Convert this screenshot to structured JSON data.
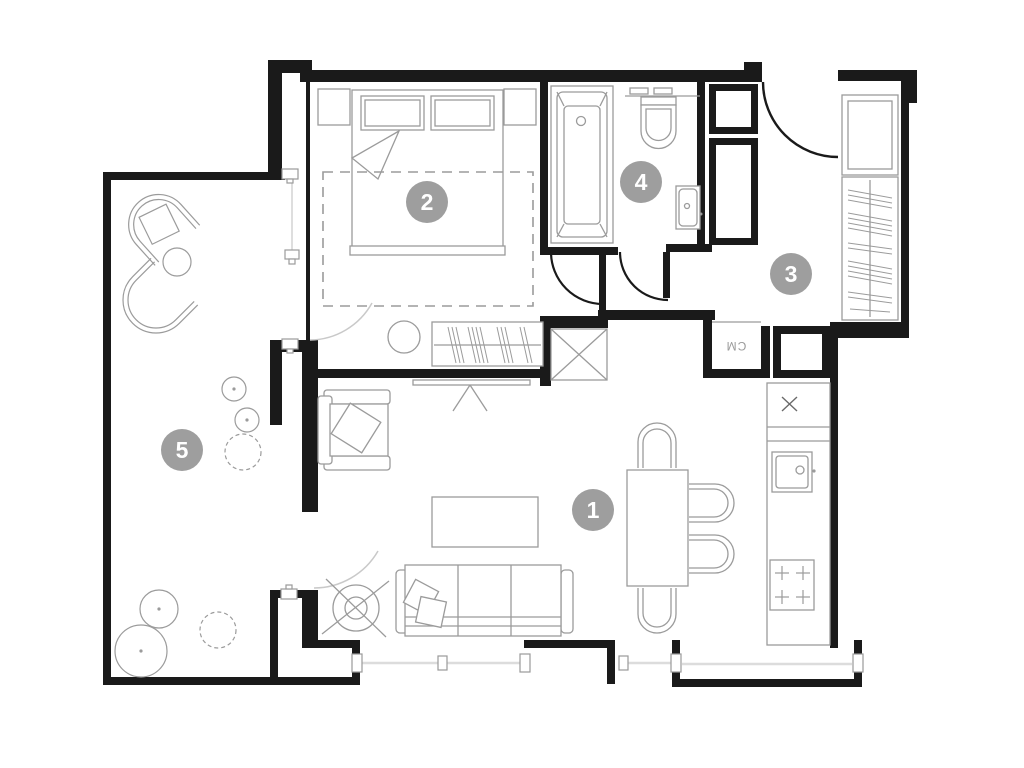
{
  "plan": {
    "type": "apartment-floor-plan",
    "colors": {
      "wall": "#1a1a1a",
      "furniture": "#9b9b9b",
      "furniture_light": "#c9c9c9",
      "badge": "#9e9e9e",
      "badge_text": "#ffffff",
      "background": "#ffffff"
    },
    "rooms": [
      {
        "id": "living-room",
        "number": "1",
        "cx": 593,
        "cy": 510
      },
      {
        "id": "bedroom",
        "number": "2",
        "cx": 427,
        "cy": 202
      },
      {
        "id": "hallway",
        "number": "3",
        "cx": 791,
        "cy": 274
      },
      {
        "id": "bathroom",
        "number": "4",
        "cx": 641,
        "cy": 182
      },
      {
        "id": "terrace",
        "number": "5",
        "cx": 182,
        "cy": 450
      }
    ],
    "labels": {
      "washing_machine": "CM"
    },
    "badge_radius": 21
  }
}
